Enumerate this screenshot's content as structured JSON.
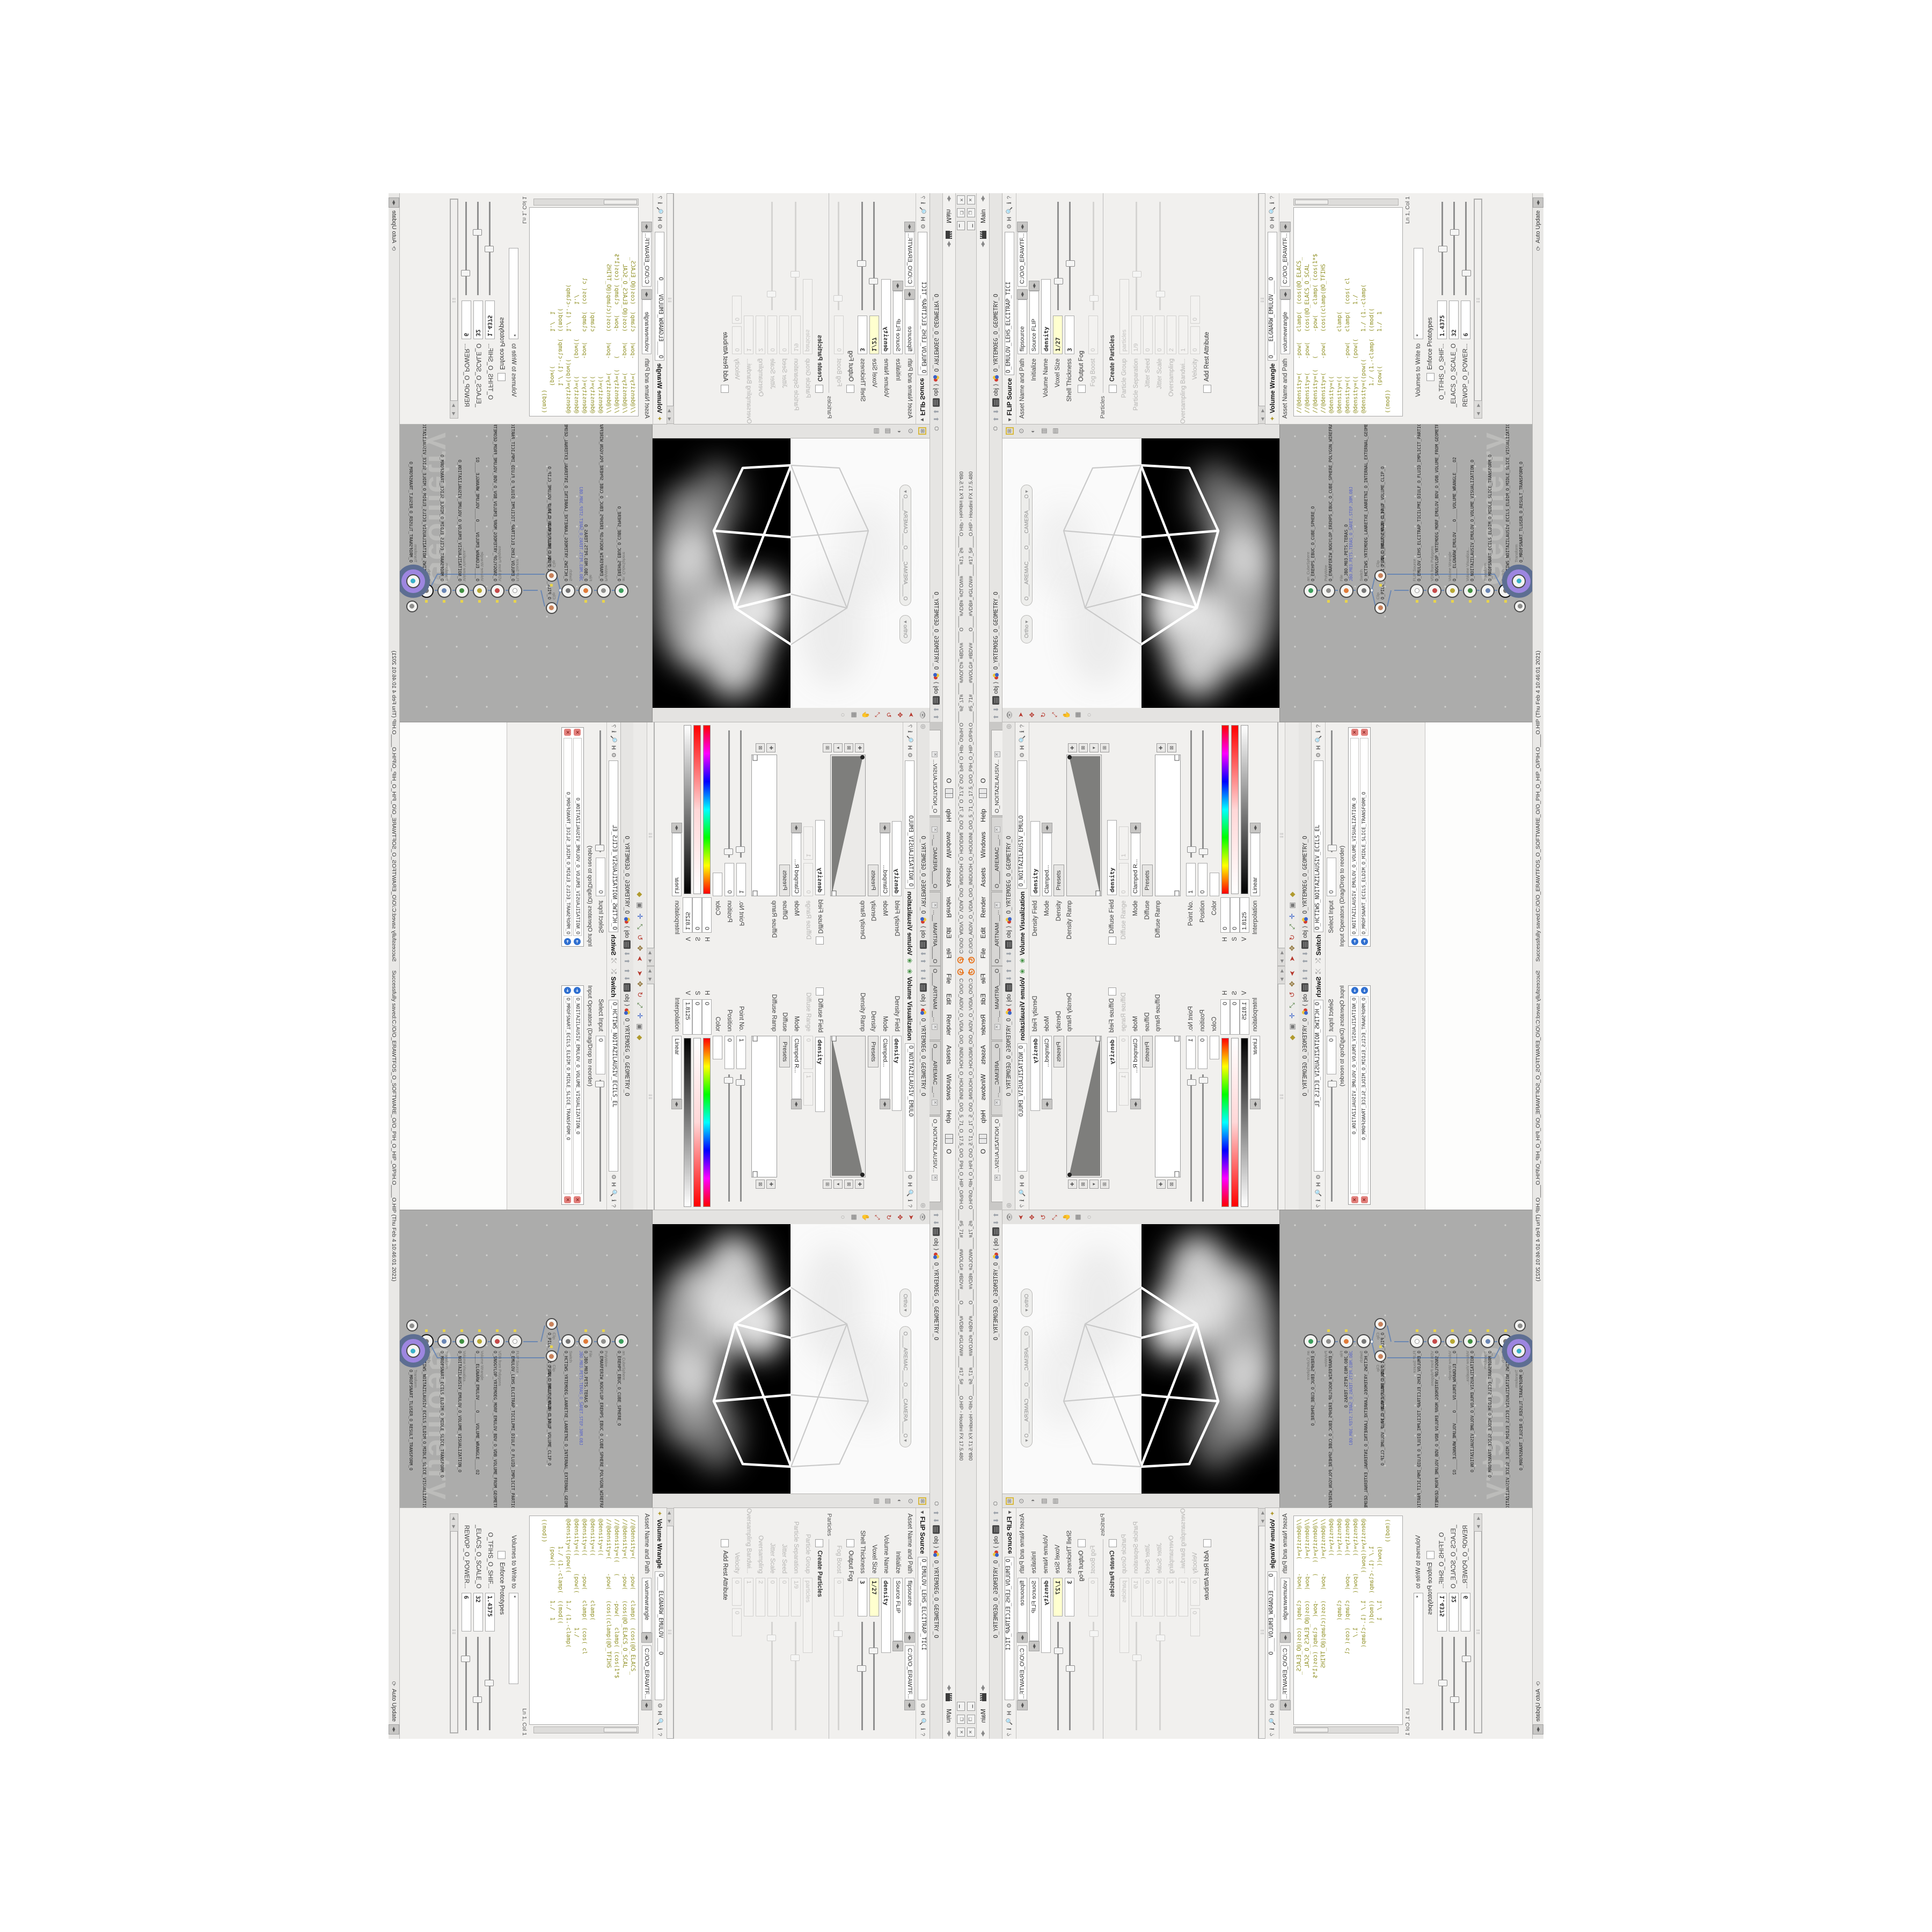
{
  "window": {
    "title": "C:/O/O_AIDIV_O_VDIA_O/O_INIDUOH_O_HOUDINI_O/O_5_71_O_17.5_O/O_PIH_O_HIP_O/PIH.O____#5_71#____#WOLG#_#BDV#____O____#VDB#_#GLOW#____#17_5#____O.HIP - Houdini FX 17.5.480",
    "minimize": "▁",
    "restore": "❐",
    "close": "✕"
  },
  "menu": {
    "items": [
      "File",
      "Edit",
      "Render",
      "Assets",
      "Windows",
      "Help"
    ],
    "layout_letter": "O",
    "desktop": "Main"
  },
  "left_tabs": [
    "O____ARTNAM __...",
    "O____AREMAC __...",
    "O_NOITAZILAUSIV..."
  ],
  "path": {
    "root": "obj",
    "sep": "⟩",
    "node": "O_YRTEMOEG_O_GEOMETRY_O"
  },
  "volviz": {
    "title": "Volume Visualization",
    "name": "O_NOITAZILAUSIV_EMULO",
    "density_field_label": "Density Field",
    "density_field": "density",
    "mode_label": "Mode",
    "mode": "Clamped...",
    "density_label": "Density",
    "presets": "Presets",
    "density_ramp_label": "Density Ramp",
    "diffuse_field_label": "Diffuse Field",
    "diffuse_field": "density",
    "diffuse_range_label": "Diffuse Range",
    "diffuse_range_min": "0",
    "diffuse_range_max": "1",
    "mode2_label": "Mode",
    "mode2": "Clamped R...",
    "diffuse_label": "Diffuse",
    "presets2": "Presets",
    "diffuse_ramp_label": "Diffuse Ramp",
    "point_label": "Point No.",
    "point": "1",
    "position_label": "Position",
    "position": "0",
    "color_label": "Color",
    "h_label": "H",
    "h": "0",
    "s_label": "S",
    "s": "0",
    "v_label": "V",
    "v": "1.8125",
    "interp_label": "Interpolation",
    "interp": "Linear"
  },
  "switch": {
    "title": "Switch",
    "name": "O_HCTIWS_NOITAZILAUSIV_ECILS_EL",
    "select_input_label": "Select Input",
    "select_input": "0",
    "list_label": "Input Operators (Drag/Drop to reorder)",
    "inputs": [
      "O_NOITAZILAUSIV_EMULOV_O_VOLUME_VISUALIZATION_O",
      "O_MROFSNART_ECILS_ELDIM_O_MIDLE_SLICE_TRANSFORM_O"
    ]
  },
  "viewport": {
    "ortho": "Ortho ▾",
    "camera": "O____AREMAC____O____CAMERA____O ▾"
  },
  "network": {
    "watermark": "Geometry",
    "nodes": [
      {
        "type": "an_CubeSphere",
        "name": "O_EREHPS_EBUC_O_CUBE_SPHERE_O"
      },
      {
        "type": "PolyWire",
        "name": "O_EMARFERIW_NOGYLOP_EREHPS_EBUC_O_CUBE_SPHERE_POLYGON_WIREFRAME_O"
      },
      {
        "type": "File",
        "name": "O_JBO.M03.PETS.TERAS_O",
        "note": "JBO.M03.PETS.TERAS_O_SARET.STEP.30M.OBJ"
      },
      {
        "type": "Switch",
        "name": "O_HCTIWS_YRTEMOEG_LANRETXE_LANRETNI_O_INTERNAL_EXTERNAL_GEOMETRY_SWITCH_O"
      },
      {
        "type": "Clip",
        "name": "O_PILC_EGAMI_FLAH_O_HALF_IMAGE_CLIP_O"
      },
      {
        "type": "Clip",
        "name": "O_PILC_EMULOV_FLAH_O_HALF_VOLUME_CLIP_O"
      },
      {
        "type": "FLIP Source",
        "name": "O_EMULOV_LEHS_ELCITRAP_TICILPMI_DIULF_O_FLUID_IMPLICIT_PARTICLE_SHEL_VOLUME_O"
      },
      {
        "type": "VDB from Polygons",
        "name": "O_SNOGYLOP_YRTEMOEG_MORF_EMULOV_BDV_O_VDB_VOLUME_FROM_GEOMETRY_POLYGONS_O"
      },
      {
        "type": "Volume Wrangle",
        "name": "O____ELGNARW_EMULOV____O____VOLUME_WRANGLE____O2"
      },
      {
        "type": "Volume Visualiza...",
        "name": "O_NOITAZILAUSIV_EMULOV_O_VOLUME_VISUALIZATION_O"
      },
      {
        "type": "Transform",
        "name": "O_MROFSNART_ECILS_ELDIM_O_MIDLE_SLICE_TRANSFORM_O"
      },
      {
        "type": "Switch",
        "name": "O_HCTIWS_NOITAZILAUSIV_ECILS_ELDIM_O_MIDLE_SLICE_VISUALIZATION_SWITCH_O"
      },
      {
        "type": "Merge",
        "name": "O_ECAFRUS_HTIW_EMULOV_EGREM_O_MERGE_VOLUME_WITH_SURFACE_O"
      },
      {
        "type": "Transform",
        "name": "O_MROFSNART_TLUSER_O_RESULT_TRANSFORM_O"
      }
    ]
  },
  "flip": {
    "title": "FLIP Source",
    "name": "O_EMULOV_LEHS_ELCITRAP_TICI",
    "asset_label": "Asset Name and Path",
    "asset_op": "flipsource",
    "asset_path": "C:/O/O_ERAWTF...",
    "initialize_label": "Initialize",
    "initialize": "Source FLIP",
    "volume_name_label": "Volume Name",
    "volume_name": "density",
    "voxel_size_label": "Voxel Size",
    "voxel_size": "1/27",
    "shell_label": "Shell Thickness",
    "shell": "3",
    "output_fog_label": "Output Fog",
    "fog_boost_label": "Fog Boost",
    "fog_boost": "0",
    "particles_group": "Particles",
    "create_particles_label": "Create Particles",
    "particle_group_label": "Particle Group",
    "particle_group": "particles",
    "particle_sep_label": "Particle Separation",
    "particle_sep": "1/9",
    "jitter_seed_label": "Jitter Seed",
    "jitter_seed": "0",
    "jitter_scale_label": "Jitter Scale",
    "jitter_scale": "0",
    "oversampling_label": "Oversampling",
    "oversampling": "2",
    "oversampling_bw_label": "Oversampling Bandwi...",
    "oversampling_bw": "1",
    "velocity_label": "Velocity",
    "velocity": "0",
    "add_rest_label": "Add Rest Attribute"
  },
  "wrangle": {
    "title": "Volume Wrangle",
    "name": "O____ELGNARW_EMULOV____O",
    "asset_label": "Asset Name and Path",
    "asset_op": "volumewrangle",
    "asset_path": "C:/O/O_ERAWTF...",
    "code": [
      "//@density=(    -pow(   clamp(  (cos(@O_ELACS_",
      "//@density=(    -pow(   (cos(@O_ELACS_O_SCAL",
      "//@density=((   (       -pow(   clamp( (cos(1*$",
      "//@density=(    -pow(   (cos((clamp(@O_TFIHS",
      "@density=((",
      "@density=((             clamp(",
      "@density=((     -pow(   clamp(  (cos( cl",
      "@density=((     (pow((          1./",
      "@density=((pow((        1./ (1.-clamp(",
      "        1./ (1.-clamp(  ((mod((",
      "        (pow((          1./  1",
      "((mod))"
    ],
    "lncol": "Ln 1, Col 1",
    "volumes_label": "Volumes to Write to",
    "volumes": "*",
    "enforce_label": "Enforce Prototypes",
    "params": [
      {
        "label": "O_TFIHS_O_SHIF...",
        "value": "1.4375"
      },
      {
        "label": "_ELACS_O_SCALE_O",
        "value": "32"
      },
      {
        "label": "REWOP_O_POWER...",
        "value": "6"
      }
    ]
  },
  "status": {
    "message": "Successfully saved:C:/O/O_ERAWTFOS_O_SOFTWARE_O/O_PIH_O_HIP_O/PIH.O____O.HIP (Thu Feb 4 10:46:01 2021)",
    "update_mode": "Auto Update"
  }
}
